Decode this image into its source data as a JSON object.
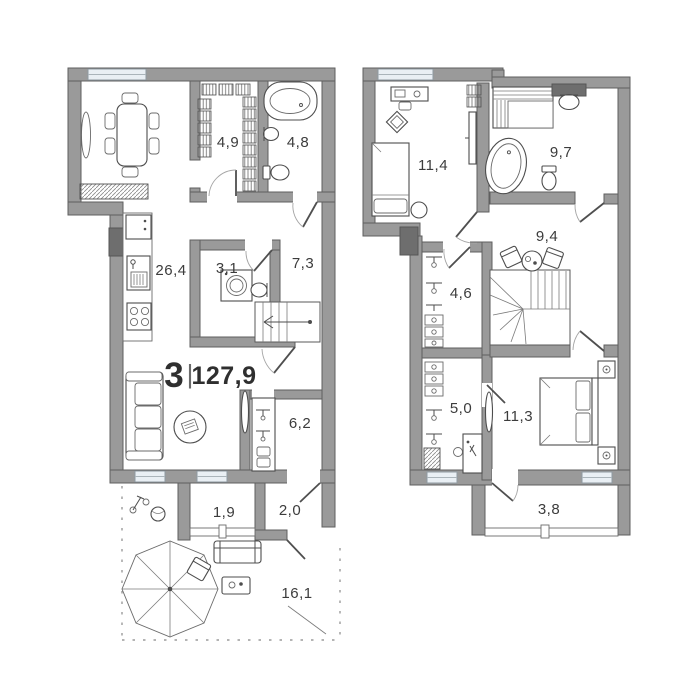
{
  "plan": {
    "summary": {
      "rooms": "3",
      "divider": "|",
      "total_area": "127,9"
    },
    "floors": [
      {
        "name": "floor-1",
        "rooms": [
          {
            "area": "4,9"
          },
          {
            "area": "4,8"
          },
          {
            "area": "26,4"
          },
          {
            "area": "3,1"
          },
          {
            "area": "7,3"
          },
          {
            "area": "6,2"
          },
          {
            "area": "1,9"
          },
          {
            "area": "2,0"
          },
          {
            "area": "16,1"
          }
        ]
      },
      {
        "name": "floor-2",
        "rooms": [
          {
            "area": "11,4"
          },
          {
            "area": "9,7"
          },
          {
            "area": "9,4"
          },
          {
            "area": "4,6"
          },
          {
            "area": "5,0"
          },
          {
            "area": "11,3"
          },
          {
            "area": "3,8"
          }
        ]
      }
    ],
    "colors": {
      "background": "#ffffff",
      "wall": "#9a9a9a",
      "wall_outline": "#5f5f5f",
      "wall_dark": "#6e6e6e",
      "window": "#e9eff4",
      "furniture_line": "#4d4d4d",
      "text": "#3c3c3c"
    }
  }
}
